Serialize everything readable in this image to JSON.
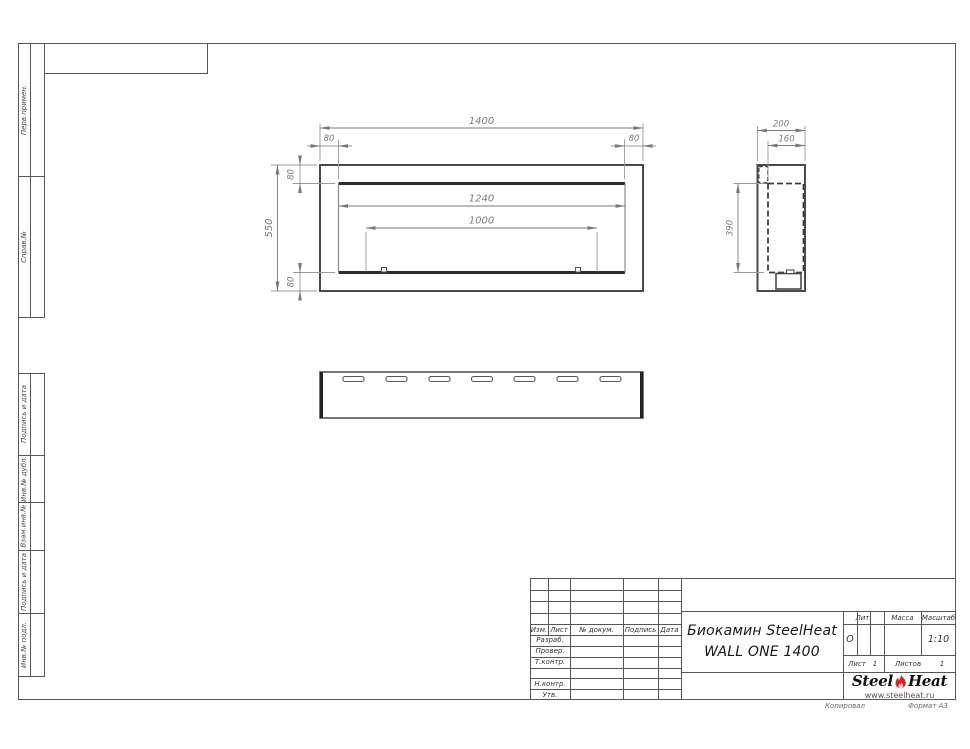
{
  "sheet": {
    "copied_label": "Копировал",
    "format": "Формат А3"
  },
  "side_column": {
    "groups": [
      {
        "labels": [
          "Перв.примен.",
          "Справ.№"
        ]
      },
      {
        "labels": [
          "Подпись и дата",
          "Инв.№ дубл.",
          "Взам.инв.№",
          "Подпись и дата",
          "Инв.№ подл."
        ]
      }
    ]
  },
  "dims": {
    "front_total_width": "1400",
    "front_offset_left": "80",
    "front_offset_right": "80",
    "front_border_top": "80",
    "front_border_bottom": "80",
    "front_height": "550",
    "front_opening_width": "1240",
    "front_burner_spacing": "1000",
    "side_depth": "200",
    "side_inner_depth": "160",
    "side_inner_height": "390"
  },
  "title_block": {
    "revision_header": [
      "Изм.",
      "Лист",
      "№ докум.",
      "Подпись",
      "Дата"
    ],
    "role_rows": [
      "Разраб.",
      "Провер.",
      "Т.контр.",
      "",
      "Н.контр.",
      "Утв."
    ],
    "doc_title_line1": "Биокамин SteelHeat",
    "doc_title_line2": "WALL ONE 1400",
    "lit_label": "Лит.",
    "lit_value": "О",
    "mass_label": "Масса",
    "mass_value": "",
    "scale_label": "Масштаб",
    "scale_value": "1:10",
    "sheet_label": "Лист",
    "sheet_value": "1",
    "sheets_label": "Листов",
    "sheets_value": "1"
  },
  "logo": {
    "brand_part1": "Steel",
    "brand_part2": "Heat",
    "website": "www.steelheat.ru"
  }
}
